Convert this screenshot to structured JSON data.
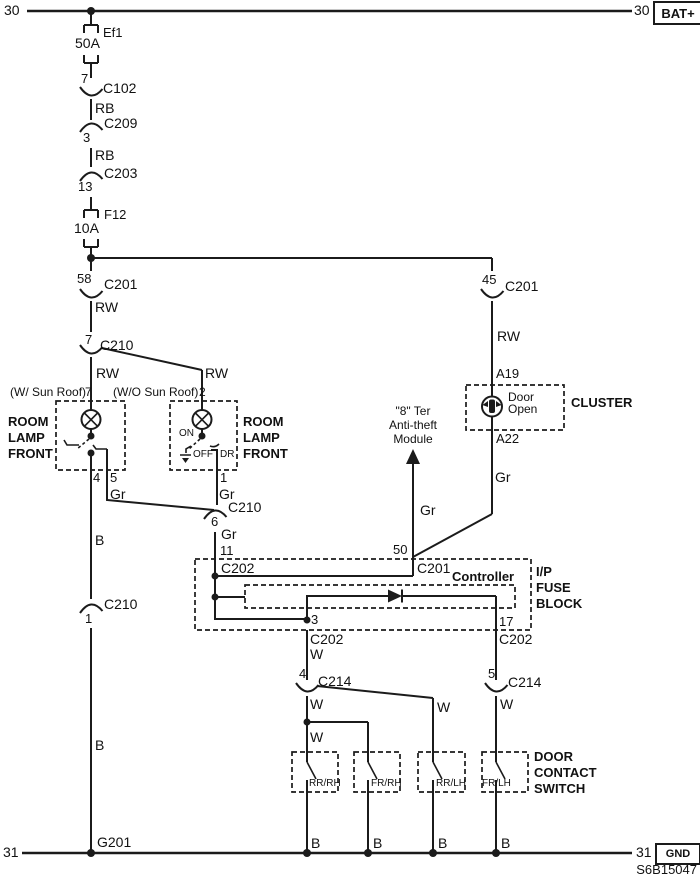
{
  "diagram": {
    "code": "S6B15047"
  },
  "rails": {
    "top": {
      "left": "30",
      "right": "30",
      "box": "BAT+"
    },
    "bottom": {
      "left": "31",
      "right": "31",
      "box": "GND",
      "ground_point": "G201"
    }
  },
  "fuses": {
    "ef1": {
      "id": "Ef1",
      "rating": "50A"
    },
    "f12": {
      "id": "F12",
      "rating": "10A"
    }
  },
  "connectors": {
    "c102": {
      "pin": "7",
      "id": "C102"
    },
    "c209": {
      "pin": "3",
      "id": "C209"
    },
    "c203": {
      "pin": "13",
      "id": "C203"
    },
    "c201_58": {
      "pin": "58",
      "id": "C201"
    },
    "c210_7": {
      "pin": "7",
      "id": "C210"
    },
    "c201_45": {
      "pin": "45",
      "id": "C201"
    },
    "c210_6": {
      "pin": "6",
      "id": "C210"
    },
    "c210_1": {
      "pin": "1",
      "id": "C210"
    },
    "c214_4": {
      "pin": "4",
      "id": "C214"
    },
    "c214_5": {
      "pin": "5",
      "id": "C214"
    }
  },
  "wire_labels": {
    "rb_1": "RB",
    "rb_2": "RB",
    "rw_main": "RW",
    "rw_lamp_left": "RW",
    "rw_lamp_right": "RW",
    "rw_cluster": "RW",
    "gr_pin5": "Gr",
    "gr_pin1": "Gr",
    "gr_block": "Gr",
    "gr_anti_theft": "Gr",
    "gr_cluster": "Gr",
    "b_upper": "B",
    "b_lower": "B",
    "b_sw": [
      "B",
      "B",
      "B",
      "B"
    ],
    "w_pin3": "W",
    "w_sw1": "W",
    "w_sw2": "W",
    "w_sw3": "W",
    "w_sw4": "W"
  },
  "room_lamp_left": {
    "variant": "(W/ Sun Roof)",
    "feed_pin": "7",
    "name_lines": [
      "ROOM",
      "LAMP",
      "FRONT"
    ],
    "pin_4": "4",
    "pin_5": "5"
  },
  "room_lamp_right": {
    "variant": "(W/O Sun Roof)",
    "feed_pin": "2",
    "name_lines": [
      "ROOM",
      "LAMP",
      "FRONT"
    ],
    "pos_on": "ON",
    "pos_off": "OFF",
    "pos_dr": "DR",
    "pin_1": "1"
  },
  "cluster": {
    "name": "CLUSTER",
    "pin_in": "A19",
    "pin_out": "A22",
    "indicator": [
      "Door",
      "Open"
    ]
  },
  "anti_theft": {
    "lines": [
      "\"8\" Ter",
      "Anti-theft",
      "Module"
    ]
  },
  "ip_fuse_block": {
    "name_lines": [
      "I/P",
      "FUSE",
      "BLOCK"
    ],
    "controller_label": "Controller",
    "pin_11": "11",
    "pin_11_conn": "C202",
    "pin_50": "50",
    "pin_50_conn": "C201",
    "pin_3": "3",
    "pin_3_conn": "C202",
    "pin_17": "17",
    "pin_17_conn": "C202"
  },
  "door_contact": {
    "name_lines": [
      "DOOR",
      "CONTACT",
      "SWITCH"
    ],
    "switches": [
      "RR/RH",
      "FR/RH",
      "RR/LH",
      "FR/LH"
    ]
  }
}
